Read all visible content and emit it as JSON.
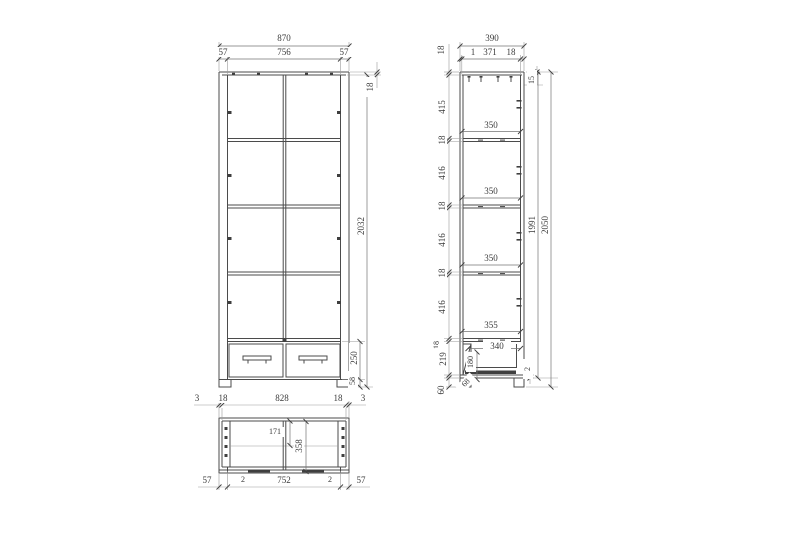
{
  "drawing": {
    "type": "furniture technical drawing, three orthographic views (front, side, horizontal section)",
    "units": "mm"
  },
  "front_view": {
    "overall_width": "870",
    "left_panel": "57",
    "inner_width": "756",
    "right_panel": "57",
    "top_thickness": "18",
    "body_height": "2032",
    "drawer_front_height": "250",
    "base_height": "58"
  },
  "side_view": {
    "overall_depth": "390",
    "front_edge": "1",
    "inner_depth": "371",
    "back_panel": "18",
    "top_thickness": "18",
    "back_top_offset": "15",
    "section_1": "415",
    "shelf_1": "18",
    "clear_1": "350",
    "section_2": "416",
    "shelf_2": "18",
    "clear_2": "350",
    "section_3": "416",
    "shelf_3": "18",
    "clear_3": "350",
    "section_4": "416",
    "shelf_4": "18",
    "clear_4": "355",
    "drawer_section": "219",
    "drawer_depth": "340",
    "drawer_height": "180",
    "bottom_gap": "2",
    "plinth_height": "60",
    "leg_height": "68",
    "carcass_height": "1991",
    "overall_height": "2050"
  },
  "bottom_view": {
    "edge_left": "3",
    "panel_left": "18",
    "inner_width": "828",
    "panel_right": "18",
    "edge_right": "3",
    "back_inset": "171",
    "inner_depth": "358",
    "stile_left": "57",
    "gap_left": "2",
    "door_width": "752",
    "gap_right": "2",
    "stile_right": "57"
  },
  "colors": {
    "object_line": "#4b4b4b",
    "dimension_line": "#757575",
    "text": "#3a3a3a",
    "background": "#ffffff"
  }
}
